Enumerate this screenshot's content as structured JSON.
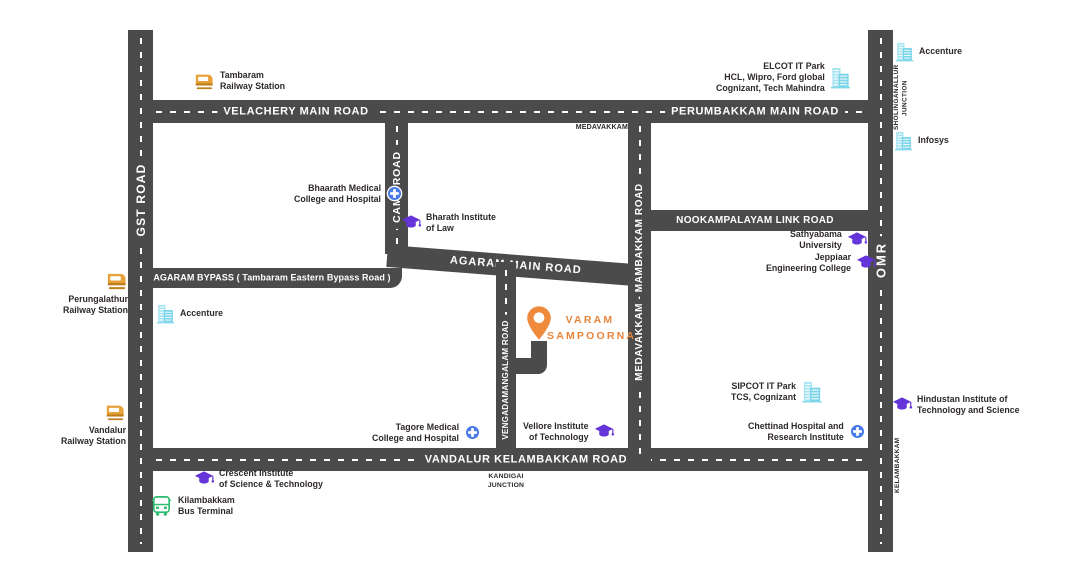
{
  "map": {
    "colors": {
      "background": "#ffffff",
      "road": "#4b4b4b",
      "road_label_text": "#ffffff",
      "landmark_text": "#2e282a",
      "project_orange": "#ee8a3e",
      "education_purple": "#6434d9",
      "it_park_cyan": "#79d4ea",
      "hospital_blue": "#4a7ae8",
      "bus_green": "#2abd70",
      "railway_amber": "#e8a23c"
    },
    "roads": {
      "gst": {
        "label": "GST ROAD"
      },
      "omr": {
        "label": "OMR"
      },
      "velachery": {
        "label": "VELACHERY MAIN ROAD"
      },
      "perumbakkam": {
        "label": "PERUMBAKKAM MAIN ROAD"
      },
      "vandalur_kelambakkam": {
        "label": "VANDALUR KELAMBAKKAM ROAD"
      },
      "camp": {
        "label": "CAMP ROAD"
      },
      "medavakkam_mambakkam": {
        "label": "MEDAVAKKAM - MAMBAKKAM ROAD"
      },
      "vengadamangalam": {
        "label": "VENGADAMANGALAM ROAD"
      },
      "nookampalayam": {
        "label": "NOOKAMPALAYAM LINK ROAD"
      },
      "agaram_bypass": {
        "label": "AGARAM BYPASS ( Tambaram Eastern Bypass Road )"
      },
      "agaram_main": {
        "label": "AGARAM MAIN ROAD"
      }
    },
    "junctions": {
      "medavakkam": {
        "label": "MEDAVAKKAM"
      },
      "sholinganallur": {
        "line1": "SHOLINGANALLUR",
        "line2": "JUNCTION"
      },
      "kandigai": {
        "line1": "KANDIGAI",
        "line2": "JUNCTION"
      },
      "kelambakkam": {
        "label": "KELAMBAKKAM"
      }
    },
    "project": {
      "line1": "VARAM",
      "line2": "SAMPOORNA"
    },
    "landmarks": {
      "tambaram_railway": {
        "line1": "Tambaram",
        "line2": "Railway Station"
      },
      "perungalathur_railway": {
        "line1": "Perungalathur",
        "line2": "Railway Station"
      },
      "vandalur_railway": {
        "line1": "Vandalur",
        "line2": "Railway Station"
      },
      "kilambakkam_bus": {
        "line1": "Kilambakkam",
        "line2": "Bus Terminal"
      },
      "accenture_sholinganallur": {
        "line1": "Accenture"
      },
      "infosys": {
        "line1": "Infosys"
      },
      "elcot": {
        "line1": "ELCOT IT Park",
        "line2": "HCL, Wipro, Ford global",
        "line3": "Cognizant, Tech Mahindra"
      },
      "sipcot": {
        "line1": "SIPCOT IT Park",
        "line2": "TCS, Cognizant"
      },
      "accenture_gst": {
        "line1": "Accenture"
      },
      "bhaarath_medical": {
        "line1": "Bhaarath Medical",
        "line2": "College and Hospital"
      },
      "tagore_medical": {
        "line1": "Tagore Medical",
        "line2": "College and Hospital"
      },
      "chettinad_hospital": {
        "line1": "Chettinad Hospital and",
        "line2": "Research Institute"
      },
      "bharath_law": {
        "line1": "Bharath Institute",
        "line2": "of Law"
      },
      "sathyabama": {
        "line1": "Sathyabama",
        "line2": "University"
      },
      "jeppiaar": {
        "line1": "Jeppiaar",
        "line2": "Engineering College"
      },
      "vellore_vit": {
        "line1": "Vellore Institute",
        "line2": "of Technology"
      },
      "crescent": {
        "line1": "Crescent Institute",
        "line2": "of Science & Technology"
      },
      "hindustan_hits": {
        "line1": "Hindustan Institute of",
        "line2": "Technology and Science"
      }
    }
  }
}
